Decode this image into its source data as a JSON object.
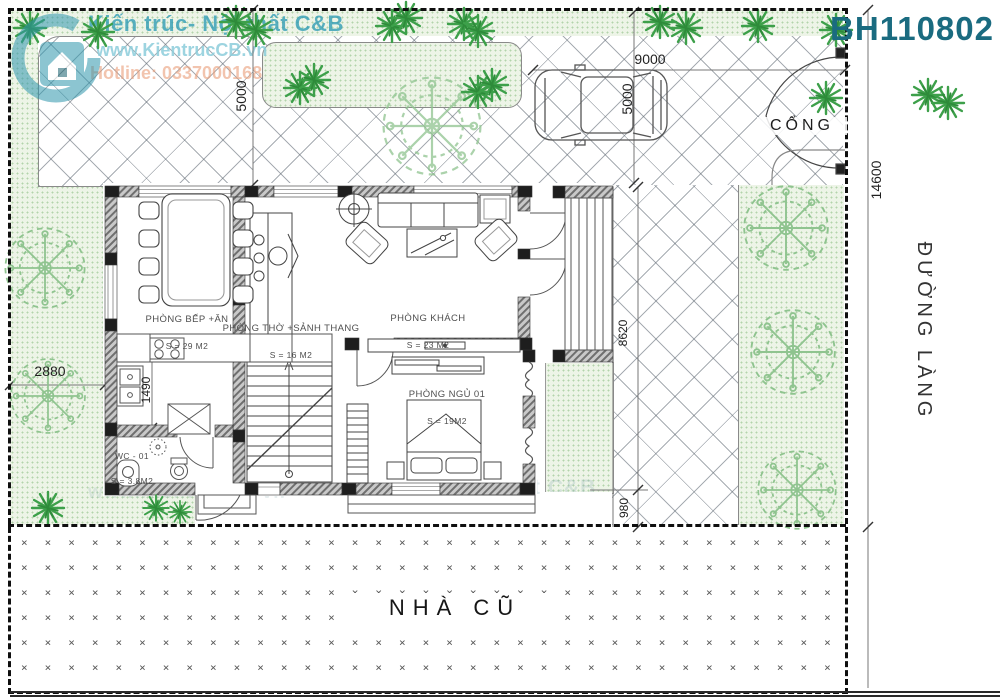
{
  "brand": {
    "name": "Kiến trúc- Nội thất C&B",
    "website": "www.KientrucCB.vn",
    "hotline": "Hotline: 0337000168",
    "code": "BH110802",
    "accent_color": "#2c9ab2",
    "code_color": "#1a6b80"
  },
  "plan": {
    "labels": {
      "gate": "CỔNG",
      "road": "ĐƯỜNG LÀNG",
      "old_house": "NHÀ CŨ"
    },
    "rooms": [
      {
        "id": "kitchen-dining",
        "name": "PHÒNG BẾP +ĂN",
        "area": "S = 29 M2"
      },
      {
        "id": "worship-stairhall",
        "name": "PHÒNG THỜ +SẢNH THANG",
        "area": "S = 16 M2"
      },
      {
        "id": "living",
        "name": "PHÒNG KHÁCH",
        "area": "S = 23 M2"
      },
      {
        "id": "bedroom-01",
        "name": "PHÒNG NGỦ 01",
        "area": "S = 19M2"
      },
      {
        "id": "wc-01",
        "name": "WC - 01",
        "area": "S = 3.8M2"
      }
    ],
    "dimensions": {
      "parking_width": "9000",
      "parking_depth": "5000",
      "left_yard_depth": "5000",
      "lot_depth": "14600",
      "left_setback": "2880",
      "kitchen_counter": "1490",
      "side_yard": "8620",
      "rear_gap": "980"
    }
  }
}
